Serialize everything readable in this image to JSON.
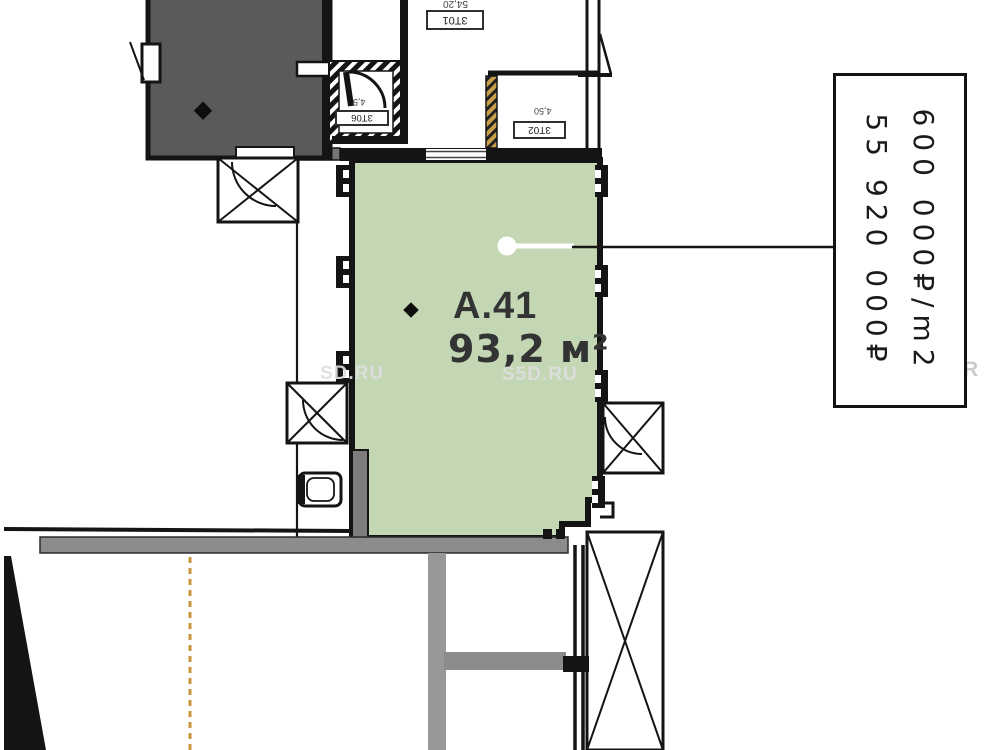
{
  "plan": {
    "unit": {
      "id": "A.41",
      "area": "93,2 м²"
    },
    "price": {
      "per_m2": "600 000₽/m2",
      "total": "55 920 000₽"
    },
    "rooms": {
      "r3t01": {
        "id": "3Т01",
        "area": "54,20"
      },
      "r3t02": {
        "id": "3Т02",
        "area": "4,50"
      },
      "r3t06": {
        "id": "3Т06",
        "area": "4,5"
      }
    },
    "watermarks": {
      "wm1": "SD.RU",
      "wm2": "S5D.RU",
      "wm3": "R"
    },
    "colors": {
      "unit_fill": "#c3d7b4",
      "occupied_fill": "#5a5a5a",
      "wall": "#141414",
      "gray_band": "#8c8c8c",
      "dash_line": "#c8963c",
      "gold_hatch": "#c9a04a"
    }
  }
}
